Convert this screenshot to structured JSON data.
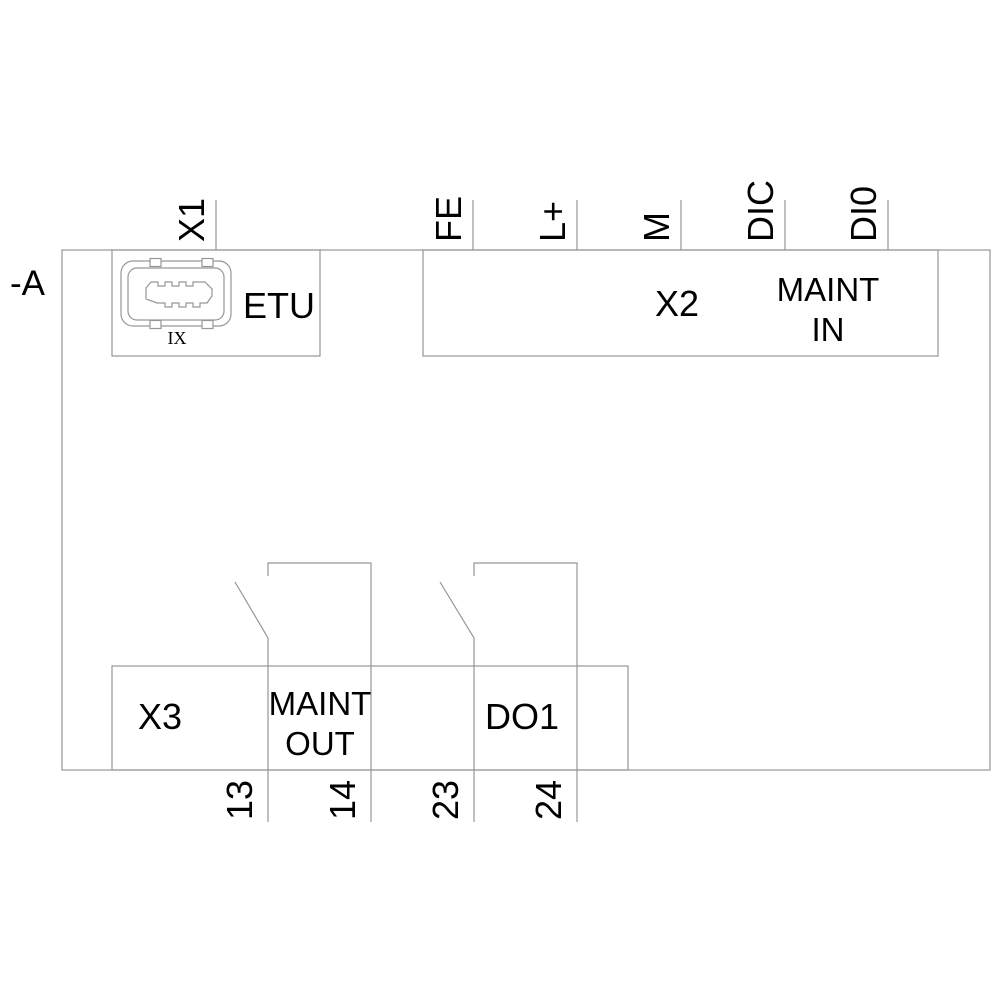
{
  "diagram": {
    "device_tag": "-A",
    "x1": {
      "terminal_label": "X1",
      "connector_name": "ETU",
      "port_label": "IX"
    },
    "x2": {
      "label": "X2",
      "title_line1": "MAINT",
      "title_line2": "IN",
      "terminals": [
        "FE",
        "L+",
        "M",
        "DIC",
        "DI0"
      ]
    },
    "x3": {
      "label": "X3",
      "title_line1": "MAINT",
      "title_line2": "OUT",
      "relay_label": "DO1",
      "terminals": [
        "13",
        "14",
        "23",
        "24"
      ]
    },
    "colors": {
      "line": "#969696",
      "text": "#000000",
      "background": "#ffffff"
    }
  }
}
